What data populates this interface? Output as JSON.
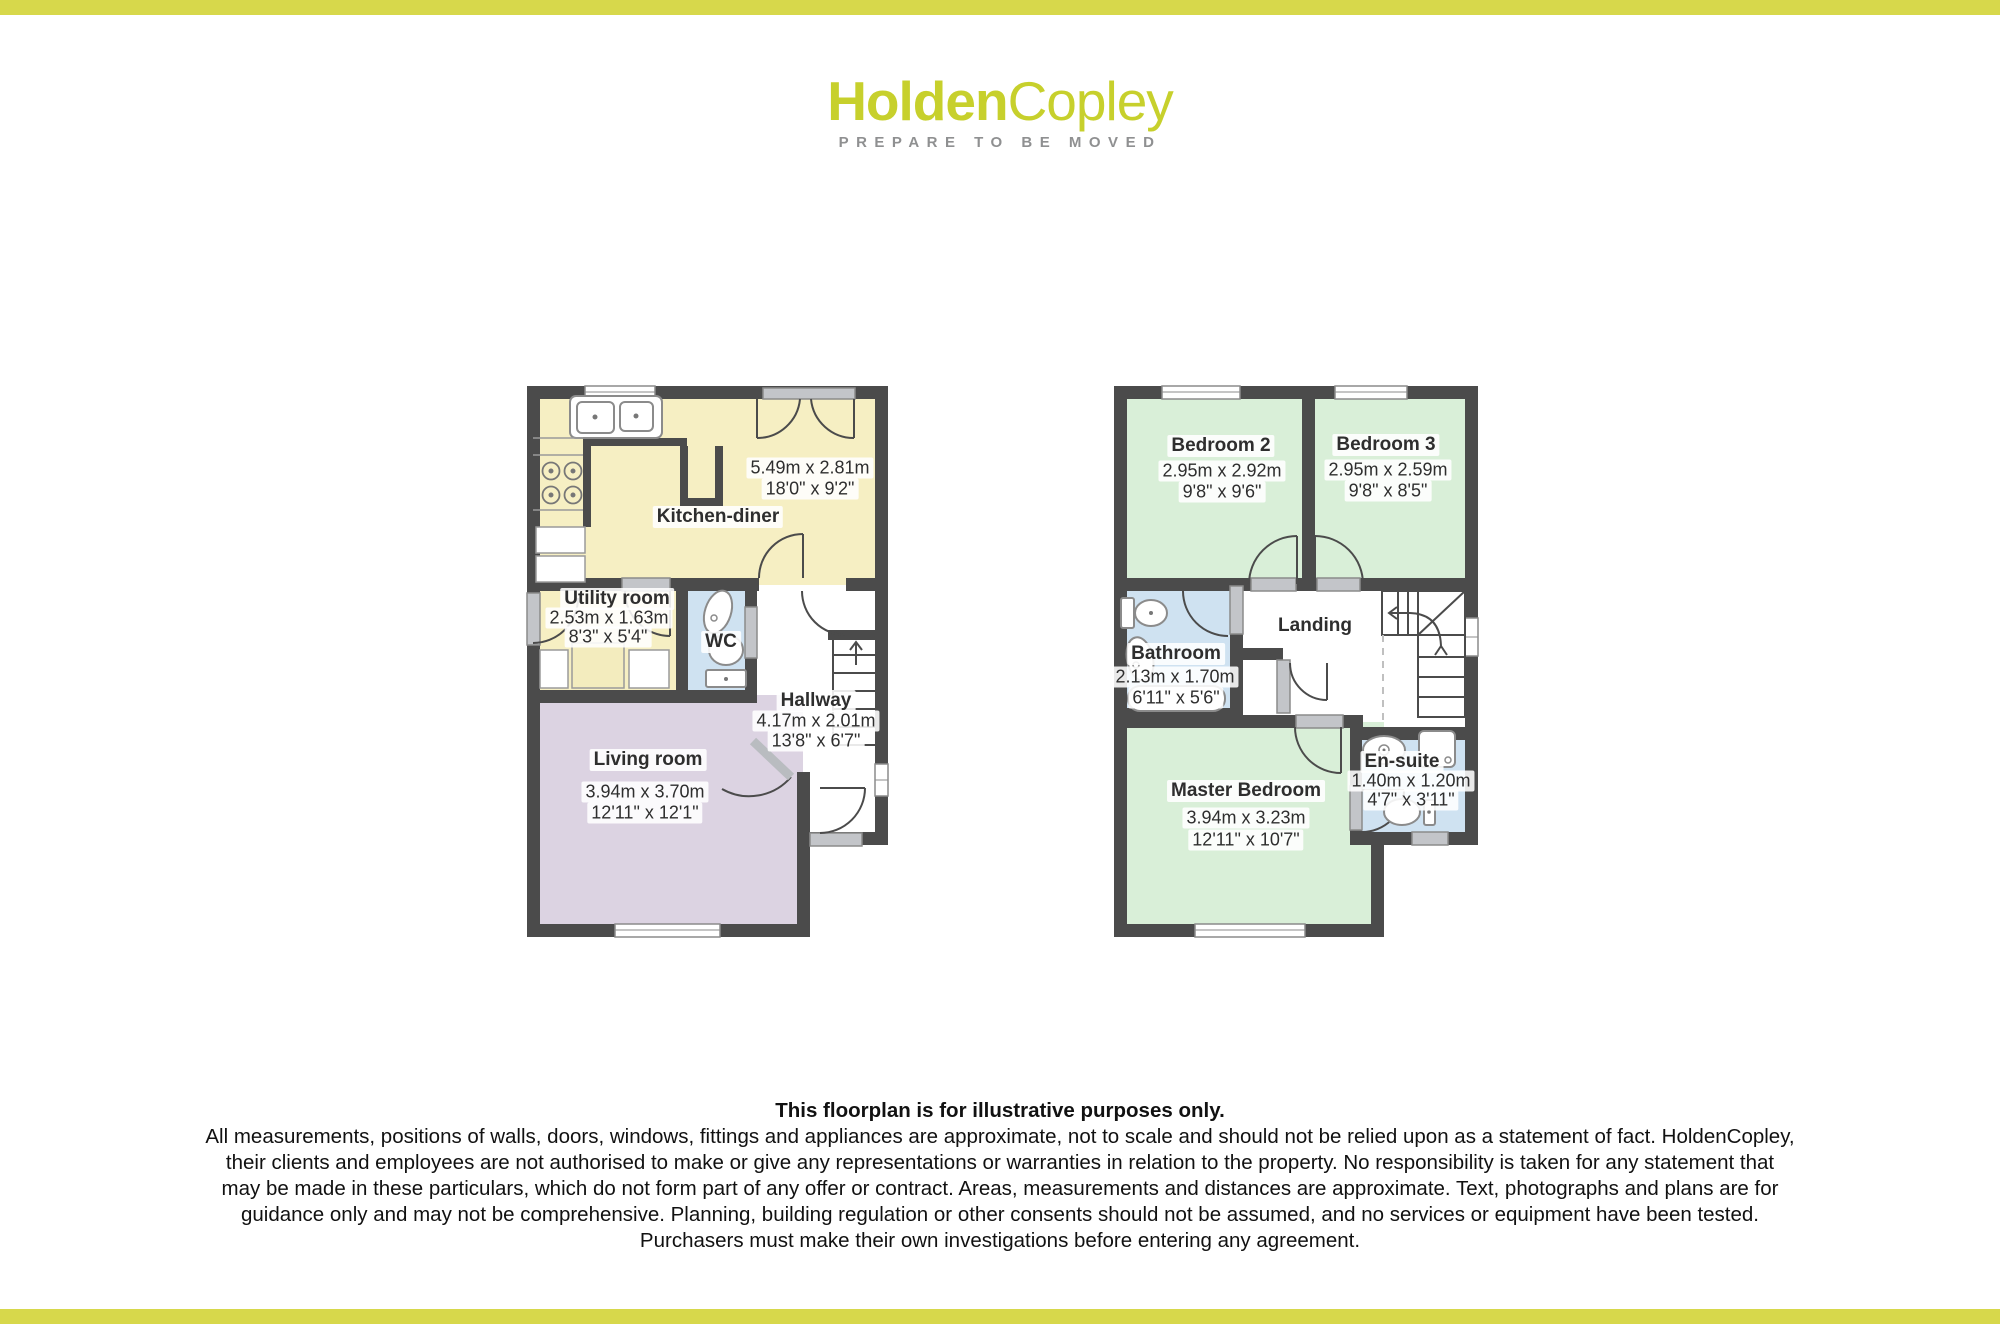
{
  "brand": {
    "logo_bold": "Holden",
    "logo_light": "Copley",
    "tagline": "PREPARE TO BE MOVED"
  },
  "floorplan": {
    "ground_floor": {
      "kitchen_diner": {
        "name": "Kitchen-diner",
        "metric": "5.49m x 2.81m",
        "imperial": "18'0\" x 9'2\""
      },
      "utility": {
        "name": "Utility room",
        "metric": "2.53m x 1.63m",
        "imperial": "8'3\" x 5'4\""
      },
      "wc": {
        "name": "WC"
      },
      "hallway": {
        "name": "Hallway",
        "metric": "4.17m x 2.01m",
        "imperial": "13'8\" x 6'7\""
      },
      "living": {
        "name": "Living room",
        "metric": "3.94m x 3.70m",
        "imperial": "12'11\" x 12'1\""
      }
    },
    "first_floor": {
      "bedroom2": {
        "name": "Bedroom 2",
        "metric": "2.95m x 2.92m",
        "imperial": "9'8\" x 9'6\""
      },
      "bedroom3": {
        "name": "Bedroom 3",
        "metric": "2.95m x 2.59m",
        "imperial": "9'8\" x 8'5\""
      },
      "bathroom": {
        "name": "Bathroom",
        "metric": "2.13m x 1.70m",
        "imperial": "6'11\" x 5'6\""
      },
      "landing": {
        "name": "Landing"
      },
      "master": {
        "name": "Master Bedroom",
        "metric": "3.94m x 3.23m",
        "imperial": "12'11\" x 10'7\""
      },
      "ensuite": {
        "name": "En-suite",
        "metric": "1.40m x 1.20m",
        "imperial": "4'7\" x 3'11\""
      }
    }
  },
  "disclaimer": {
    "lines": [
      "This floorplan is for illustrative purposes only.",
      "All measurements, positions of walls, doors, windows, fittings and appliances are approximate, not to scale and should not be relied upon as a statement of fact. HoldenCopley,",
      "their clients and employees are not authorised to make or give any representations or warranties in relation to the property. No responsibility is taken for any statement that",
      "may be made in these particulars, which do not form part of any offer or contract. Areas, measurements and distances are approximate. Text, photographs and plans are for",
      "guidance only and may not be comprehensive. Planning, building regulation or other consents should not be assumed, and no services or equipment have been tested.",
      "Purchasers must make their own investigations before entering any agreement."
    ]
  },
  "colors": {
    "bar": "#d7d84b",
    "logo": "#c7d02c",
    "tagline": "#8f9091",
    "wall": "#4b4b4b",
    "threshold": "#c3c5c9",
    "room_cream": "#f6efc3",
    "room_lavender": "#dcd3e2",
    "room_green": "#d9efd8",
    "room_blue": "#cfe2f1"
  }
}
